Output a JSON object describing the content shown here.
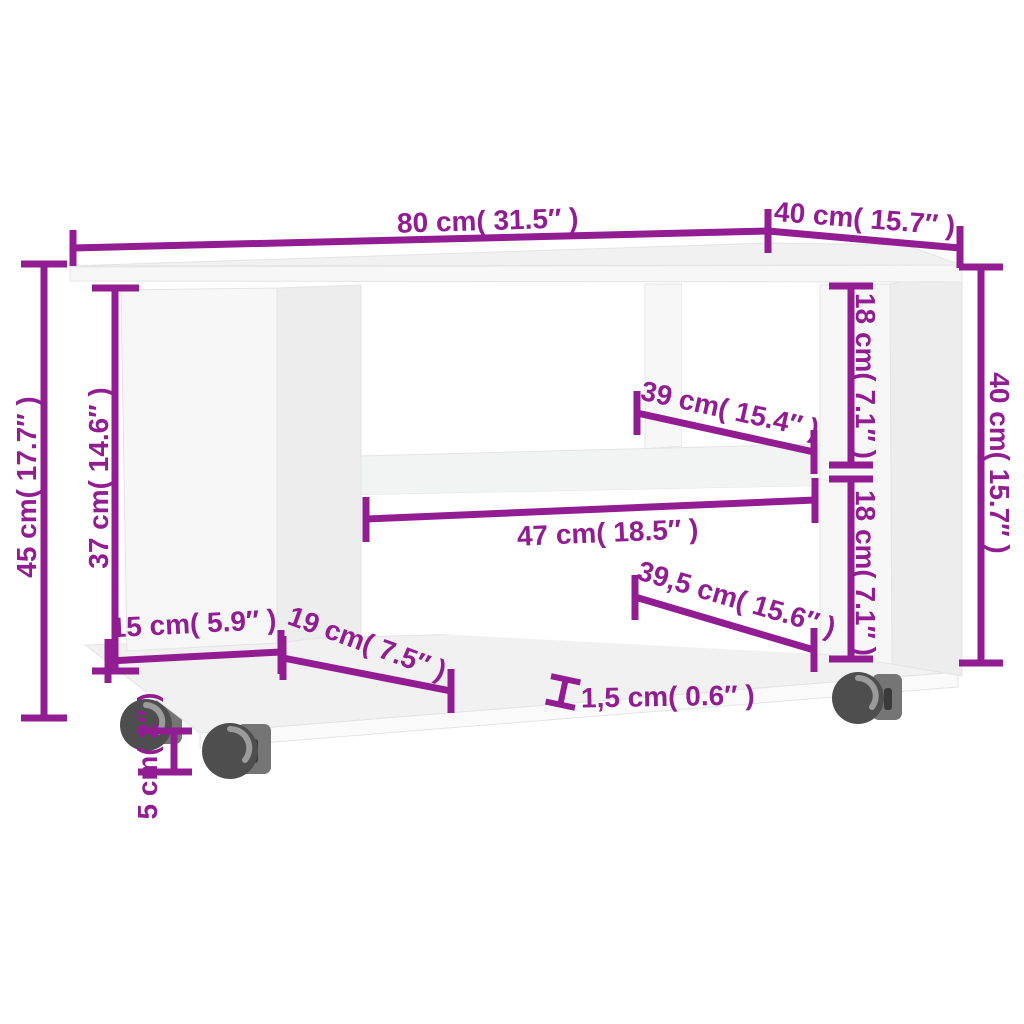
{
  "diagram": {
    "kind": "product-dimension-diagram",
    "product": "TV cabinet with castors",
    "units": "cm / inches"
  },
  "labels": {
    "width": "80 cm( 31.5″ )",
    "depth": "40 cm( 15.7″ )",
    "height": "45 cm( 17.7″ )",
    "panel_height": "37 cm( 14.6″ )",
    "upper_compartment": "18 cm( 7.1″ )",
    "lower_compartment": "18 cm( 7.1″ )",
    "side_height": "40 cm( 15.7″ )",
    "shelf_width": "39 cm( 15.4″ )",
    "opening_width": "47 cm( 18.5″ )",
    "bottom_shelf_width": "39,5 cm( 15.6″ )",
    "left_inset": "15 cm( 5.9″ )",
    "panel_depth": "19 cm( 7.5″ )",
    "castor_height": "5 cm( 2″ )",
    "thickness": "1,5 cm( 0.6″ )"
  },
  "colors": {
    "accent": "#921c92",
    "panel": "#f7f7f7",
    "panel-side": "#ededee",
    "panel-top": "#f1f1f1",
    "opening": "#ffffff",
    "floor-front": "#fafafa",
    "shelf": "#f2f3f3",
    "wheel": "#4e4e4e",
    "wheel-bracket": "#757575",
    "wheel-slot": "#9b9b9b",
    "wheel-notch": "#3a3a3a"
  }
}
